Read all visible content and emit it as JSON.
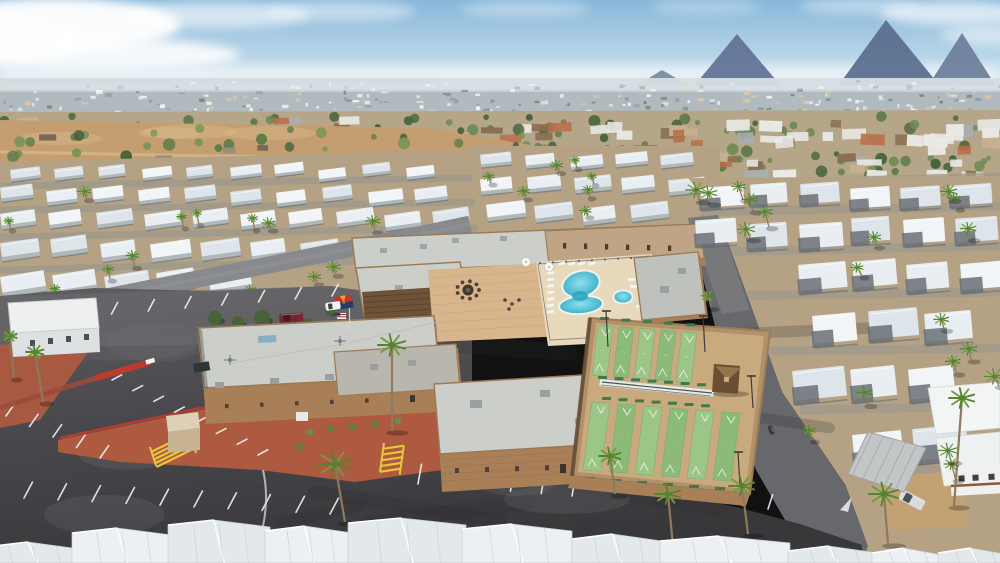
{
  "meta": {
    "width": 1000,
    "height": 563,
    "title": "Aerial drone photo of a desert mobile-home resort community"
  },
  "scene": {
    "type": "aerial-photograph",
    "description": "High oblique midday drone view of a 55+ mobile home / RV resort in the Arizona desert. Center: tan-brick clubhouse complex with white flat roofs, paver courtyard with fire pit, figure-eight swimming pool with round spa, and ten green shuffleboard courts with a small gazebo. Left: large dark asphalt parking lot with white stall stripes, red-painted median, yellow hatch markings, and red-earth planting strips. Surrounding: dense rows of white-roofed mobile homes dotted with palm trees, desert scrub, a distant suburban sprawl and hazy mountains under a pale blue sky. Arizona and US flags fly by the entrance; a white pickup, maroon minivan and silver sedan are parked.",
    "camera": "high oblique aerial",
    "lighting": "harsh midday sun, short shadows",
    "landmarks": [
      "clubhouse",
      "swimming-pool",
      "spa",
      "fire-pit-courtyard",
      "shuffleboard-courts",
      "gazebo",
      "parking-lot",
      "arizona-flag",
      "us-flag",
      "mobile-home-rows",
      "palm-trees",
      "desert-mountains"
    ]
  },
  "palette": {
    "sky_top": "#87b7da",
    "sky_mid": "#bad6e8",
    "sky_low": "#e7eff4",
    "cloud": "#ffffff",
    "mountain_a": "#5f7195",
    "mountain_b": "#596c8d",
    "mountain_c": "#6b7d9a",
    "ridge": "#7789a0",
    "city_base": "#c3ced3",
    "city_light": "#eef2f3",
    "city_dark": "#8e9da6",
    "city_green": "#74876d",
    "city_tan": "#d9c9a8",
    "suburb_base": "#b5a689",
    "roof_orange": "#b86f49",
    "roof_white": "#e9e9e5",
    "roof_gray": "#aaaeb0",
    "roof_tan": "#c7b090",
    "roof_brown": "#8a6f52",
    "tree_green": "#5f7c49",
    "tree_dark": "#47633a",
    "desert_sand": "#c49e70",
    "desert_light": "#d6b587",
    "park_ground": "#b5a284",
    "row_street": "#a19a8c",
    "mh_roof": "#e9eef2",
    "mh_roof2": "#dde4ea",
    "mh_roof3": "#f2f5f7",
    "mh_side": "#aeb9c0",
    "mh_shadow": "#5c666e",
    "road_gray": "#87898c",
    "asphalt": "#4a4a4e",
    "asphalt_light": "#5e5e61",
    "asphalt_dark": "#38383b",
    "street": "#66686b",
    "line_white": "#eceff1",
    "wall_tan": "#a97f57",
    "wall_dark": "#8a6544",
    "roof_flat": "#cbcec9",
    "roof_flat2": "#bfc2bc",
    "roof_mid": "#b9b6ae",
    "parapet": "#9b7a55",
    "paver": "#d8b58c",
    "deck": "#e8d9bc",
    "pergola": "#6e5339",
    "pool_edge": "#2aa6c4",
    "pool_core": "#8fe0ec",
    "coping": "#f2f3ef",
    "sb_border": "#b2916a",
    "sb_walk": "#c9a97e",
    "sb_green": "#9cc688",
    "sb_green2": "#8cba79",
    "bench_green": "#3e7a4c",
    "red_earth": "#ad5a41",
    "red_curb": "#c03a2b",
    "yellow": "#e8c63c",
    "palm_green": "#6f9c3f",
    "palm_dark": "#55842f",
    "palm_trunk": "#8d7a5e",
    "az_red": "#bf3927",
    "az_yellow": "#e9a23b",
    "az_blue": "#2b3a6b",
    "az_copper": "#b87333",
    "white": "#f4f6f6",
    "shed_tan": "#c8b493",
    "shed_top": "#ddd0b4"
  },
  "sky": {
    "horizon_y": 84,
    "clouds": [
      {
        "cx": 55,
        "cy": 25,
        "rx": 125,
        "ry": 27,
        "o": 0.95
      },
      {
        "cx": 95,
        "cy": 55,
        "rx": 145,
        "ry": 17,
        "o": 0.85
      },
      {
        "cx": 0,
        "cy": 40,
        "rx": 85,
        "ry": 21,
        "o": 0.9
      },
      {
        "cx": 215,
        "cy": 15,
        "rx": 95,
        "ry": 13,
        "o": 0.6
      },
      {
        "cx": 340,
        "cy": 11,
        "rx": 75,
        "ry": 10,
        "o": 0.45
      },
      {
        "cx": 525,
        "cy": 9,
        "rx": 65,
        "ry": 8,
        "o": 0.35
      },
      {
        "cx": 705,
        "cy": 7,
        "rx": 55,
        "ry": 7,
        "o": 0.3
      },
      {
        "cx": 860,
        "cy": 6,
        "rx": 60,
        "ry": 8,
        "o": 0.4
      },
      {
        "cx": 955,
        "cy": 13,
        "rx": 75,
        "ry": 12,
        "o": 0.65
      },
      {
        "cx": 1000,
        "cy": 35,
        "rx": 60,
        "ry": 10,
        "o": 0.5
      }
    ]
  },
  "mountains": [
    {
      "pts": [
        [
          694,
          86
        ],
        [
          737,
          34
        ],
        [
          781,
          86
        ]
      ],
      "c": "mountain_a"
    },
    {
      "pts": [
        [
          838,
          86
        ],
        [
          886,
          20
        ],
        [
          940,
          86
        ]
      ],
      "c": "mountain_b"
    },
    {
      "pts": [
        [
          928,
          86
        ],
        [
          962,
          33
        ],
        [
          996,
          86
        ]
      ],
      "c": "mountain_c"
    },
    {
      "pts": [
        [
          636,
          86
        ],
        [
          662,
          70
        ],
        [
          690,
          86
        ]
      ],
      "c": "ridge"
    }
  ],
  "city_band": {
    "y": 78,
    "h": 40,
    "speckles": 250
  },
  "suburbs": {
    "houses": 88,
    "trees": 130
  },
  "desert": {
    "trees": 46,
    "shacks": 6
  },
  "left_rows": [
    {
      "y": 168,
      "x0": 10,
      "x1": 466,
      "step": 44,
      "w": 30,
      "h": 9,
      "rot": -7
    },
    {
      "y": 190,
      "x0": 0,
      "x1": 468,
      "step": 46,
      "w": 33,
      "h": 11,
      "rot": -7
    },
    {
      "y": 214,
      "x0": 0,
      "x1": 472,
      "step": 48,
      "w": 36,
      "h": 12,
      "rot": -8
    },
    {
      "y": 242,
      "x0": 0,
      "x1": 420,
      "step": 50,
      "w": 40,
      "h": 14,
      "rot": -8
    },
    {
      "y": 276,
      "x0": 0,
      "x1": 280,
      "step": 52,
      "w": 44,
      "h": 16,
      "rot": -9
    }
  ],
  "top_rows": [
    {
      "y": 156,
      "x0": 480,
      "x1": 706,
      "step": 45,
      "w": 32,
      "h": 10,
      "rot": -6
    },
    {
      "y": 180,
      "x0": 480,
      "x1": 710,
      "step": 47,
      "w": 35,
      "h": 12,
      "rot": -6
    },
    {
      "y": 206,
      "x0": 486,
      "x1": 710,
      "step": 48,
      "w": 38,
      "h": 13,
      "rot": -7
    }
  ],
  "right_rows": [
    {
      "y": 186,
      "x0": 700,
      "x1": 1000,
      "step": 50,
      "w": 42,
      "h": 20,
      "rot": -4
    },
    {
      "y": 222,
      "x0": 695,
      "x1": 1000,
      "step": 52,
      "w": 44,
      "h": 24,
      "rot": -4
    },
    {
      "y": 264,
      "x0": 690,
      "x1": 1000,
      "step": 54,
      "w": 46,
      "h": 26,
      "rot": -5
    },
    {
      "y": 315,
      "x0": 700,
      "x1": 1000,
      "step": 56,
      "w": 48,
      "h": 28,
      "rot": -5
    },
    {
      "y": 372,
      "x0": 792,
      "x1": 1000,
      "step": 58,
      "w": 50,
      "h": 30,
      "rot": -6
    },
    {
      "y": 432,
      "x0": 852,
      "x1": 1000,
      "step": 60,
      "w": 52,
      "h": 32,
      "rot": -6
    }
  ],
  "row_streets_left": [
    [
      0,
      186,
      472,
      178
    ],
    [
      0,
      210,
      475,
      202
    ],
    [
      0,
      237,
      478,
      228
    ],
    [
      0,
      270,
      480,
      258
    ]
  ],
  "row_streets_right": [
    [
      690,
      184,
      1000,
      176
    ],
    [
      700,
      212,
      1000,
      206
    ],
    [
      695,
      252,
      1000,
      246
    ],
    [
      692,
      296,
      1000,
      292
    ],
    [
      700,
      352,
      1000,
      348
    ],
    [
      800,
      410,
      1000,
      406
    ],
    [
      852,
      472,
      1000,
      468
    ]
  ],
  "parking": {
    "rows": [
      {
        "x0": 38,
        "y0": 320,
        "x1": 332,
        "y1": 296,
        "n": 9,
        "len": 13,
        "ang": -62
      },
      {
        "x0": 112,
        "y0": 380,
        "x1": 258,
        "y1": 455,
        "n": 8,
        "len": 11,
        "ang": -28
      },
      {
        "x0": 6,
        "y0": 416,
        "x1": 100,
        "y1": 458,
        "n": 5,
        "len": 15,
        "ang": -55
      },
      {
        "x0": 24,
        "y0": 498,
        "x1": 330,
        "y1": 514,
        "n": 10,
        "len": 18,
        "ang": -62
      },
      {
        "x0": 418,
        "y0": 484,
        "x1": 572,
        "y1": 496,
        "n": 6,
        "len": 20,
        "ang": -80
      },
      {
        "x0": 666,
        "y0": 495,
        "x1": 768,
        "y1": 509,
        "n": 5,
        "len": 15,
        "ang": -72
      }
    ],
    "red_median": [
      [
        0,
        408
      ],
      [
        96,
        378
      ],
      [
        150,
        362
      ]
    ],
    "yellow_hatches": [
      {
        "x": 150,
        "y": 447,
        "w": 42,
        "h": 20,
        "rot": -18,
        "rungs": 5
      },
      {
        "x": 384,
        "y": 443,
        "w": 20,
        "h": 29,
        "rot": 8,
        "rungs": 5
      }
    ],
    "streaks": 12
  },
  "complex": {
    "fire_pit": {
      "cx": 468,
      "cy": 290,
      "r": 5.5,
      "chairs": 9,
      "ring": 11
    },
    "pool": {
      "upper": {
        "cx": 581,
        "cy": 284,
        "rx": 19,
        "ry": 13,
        "rot": -15
      },
      "lower": {
        "cx": 581,
        "cy": 305,
        "rx": 22,
        "ry": 9,
        "rot": -5
      }
    },
    "spa": {
      "cx": 623,
      "cy": 297,
      "rx": 9.5,
      "ry": 6.5
    },
    "umbrellas": [
      [
        549,
        267
      ],
      [
        526,
        262
      ]
    ],
    "loungers_left": {
      "x": 547,
      "y0": 272,
      "n": 7,
      "dy": 6.5
    },
    "loungers_top": {
      "y": 263,
      "x0": 558,
      "n": 4,
      "dx": 10
    },
    "loungers_right": [
      [
        628,
        278
      ],
      [
        630,
        285
      ],
      [
        636,
        305
      ],
      [
        644,
        310
      ]
    ],
    "shuffleboard": {
      "outer": [
        [
          590,
          318
        ],
        [
          770,
          331
        ],
        [
          750,
          494
        ],
        [
          572,
          476
        ]
      ],
      "upper": {
        "x0": 598,
        "y0": 325,
        "n": 5,
        "step": 21,
        "w": 15,
        "h": 50,
        "shift": -6,
        "lean": 1.6
      },
      "lower": {
        "x0": 592,
        "y0": 402,
        "n": 6,
        "step": 26,
        "w": 18,
        "h": 68,
        "shift": -9,
        "lean": 2.0
      },
      "cover": [
        [
          600,
          379
        ],
        [
          714,
          390
        ],
        [
          713,
          397
        ],
        [
          599,
          386
        ]
      ],
      "gazebo": {
        "x": 714,
        "y": 364,
        "w": 26,
        "h": 28
      },
      "poles": [
        [
          608,
          347,
          36
        ],
        [
          705,
          352,
          36
        ],
        [
          753,
          408,
          32
        ],
        [
          740,
          486,
          34
        ]
      ]
    },
    "flags": {
      "pole": [
        349,
        296,
        350,
        332
      ],
      "arizona": {
        "x": 334,
        "y": 297,
        "w": 18,
        "h": 13
      },
      "usa": {
        "x": 337,
        "y": 313,
        "w": 9,
        "h": 6
      }
    },
    "vehicles": {
      "white_pickup": {
        "x": 325,
        "y": 303,
        "w": 15,
        "h": 8,
        "rot": -8
      },
      "maroon_van": {
        "x": 279,
        "y": 314,
        "w": 24,
        "h": 9,
        "rot": -4
      },
      "silver_sedan": {
        "x": 903,
        "y": 489,
        "w": 26,
        "h": 11,
        "rot": 28
      },
      "dark_car": {
        "x": 772,
        "y": 425,
        "w": 9,
        "h": 5,
        "rot": 70
      }
    },
    "dark_trees": [
      [
        215,
        318,
        7
      ],
      [
        238,
        322,
        6
      ],
      [
        262,
        318,
        8
      ],
      [
        288,
        321,
        6
      ],
      [
        308,
        325,
        7
      ],
      [
        330,
        311,
        5
      ],
      [
        205,
        332,
        5
      ]
    ],
    "planters": [
      [
        310,
        432
      ],
      [
        330,
        429
      ],
      [
        352,
        427
      ],
      [
        375,
        424
      ],
      [
        398,
        421
      ],
      [
        300,
        447
      ]
    ]
  },
  "palms_large": [
    [
      335,
      464,
      17,
      10,
      58
    ],
    [
      610,
      456,
      11,
      5,
      38
    ],
    [
      668,
      494,
      13,
      5,
      52
    ],
    [
      742,
      486,
      13,
      6,
      48
    ],
    [
      884,
      494,
      15,
      4,
      50
    ],
    [
      962,
      398,
      13,
      -8,
      108
    ],
    [
      392,
      345,
      14,
      0,
      86
    ],
    [
      35,
      352,
      9,
      8,
      50
    ],
    [
      10,
      336,
      7,
      4,
      42
    ]
  ],
  "palm_counts": {
    "left_park": 20,
    "top_park": 7,
    "right_park": 24
  },
  "foreground_roofs": [
    [
      -15,
      95,
      542
    ],
    [
      72,
      100,
      528
    ],
    [
      168,
      102,
      520
    ],
    [
      265,
      88,
      526
    ],
    [
      348,
      118,
      518
    ],
    [
      462,
      110,
      524
    ],
    [
      572,
      90,
      534
    ],
    [
      660,
      130,
      536
    ],
    [
      788,
      90,
      546
    ],
    [
      872,
      70,
      548
    ],
    [
      938,
      72,
      548
    ]
  ],
  "office_building": {
    "roof": [
      [
        8,
        303
      ],
      [
        96,
        298
      ],
      [
        99,
        328
      ],
      [
        11,
        333
      ]
    ],
    "wall": [
      [
        11,
        331
      ],
      [
        99,
        326
      ],
      [
        100,
        352
      ],
      [
        12,
        357
      ]
    ]
  },
  "sheds": {
    "tan_shed": {
      "x": 166,
      "y": 412,
      "w": 32,
      "h": 38
    },
    "white_box": {
      "x": 296,
      "y": 412,
      "w": 12,
      "h": 9
    },
    "dumpster": {
      "x": 193,
      "y": 364,
      "w": 16,
      "h": 9
    }
  }
}
